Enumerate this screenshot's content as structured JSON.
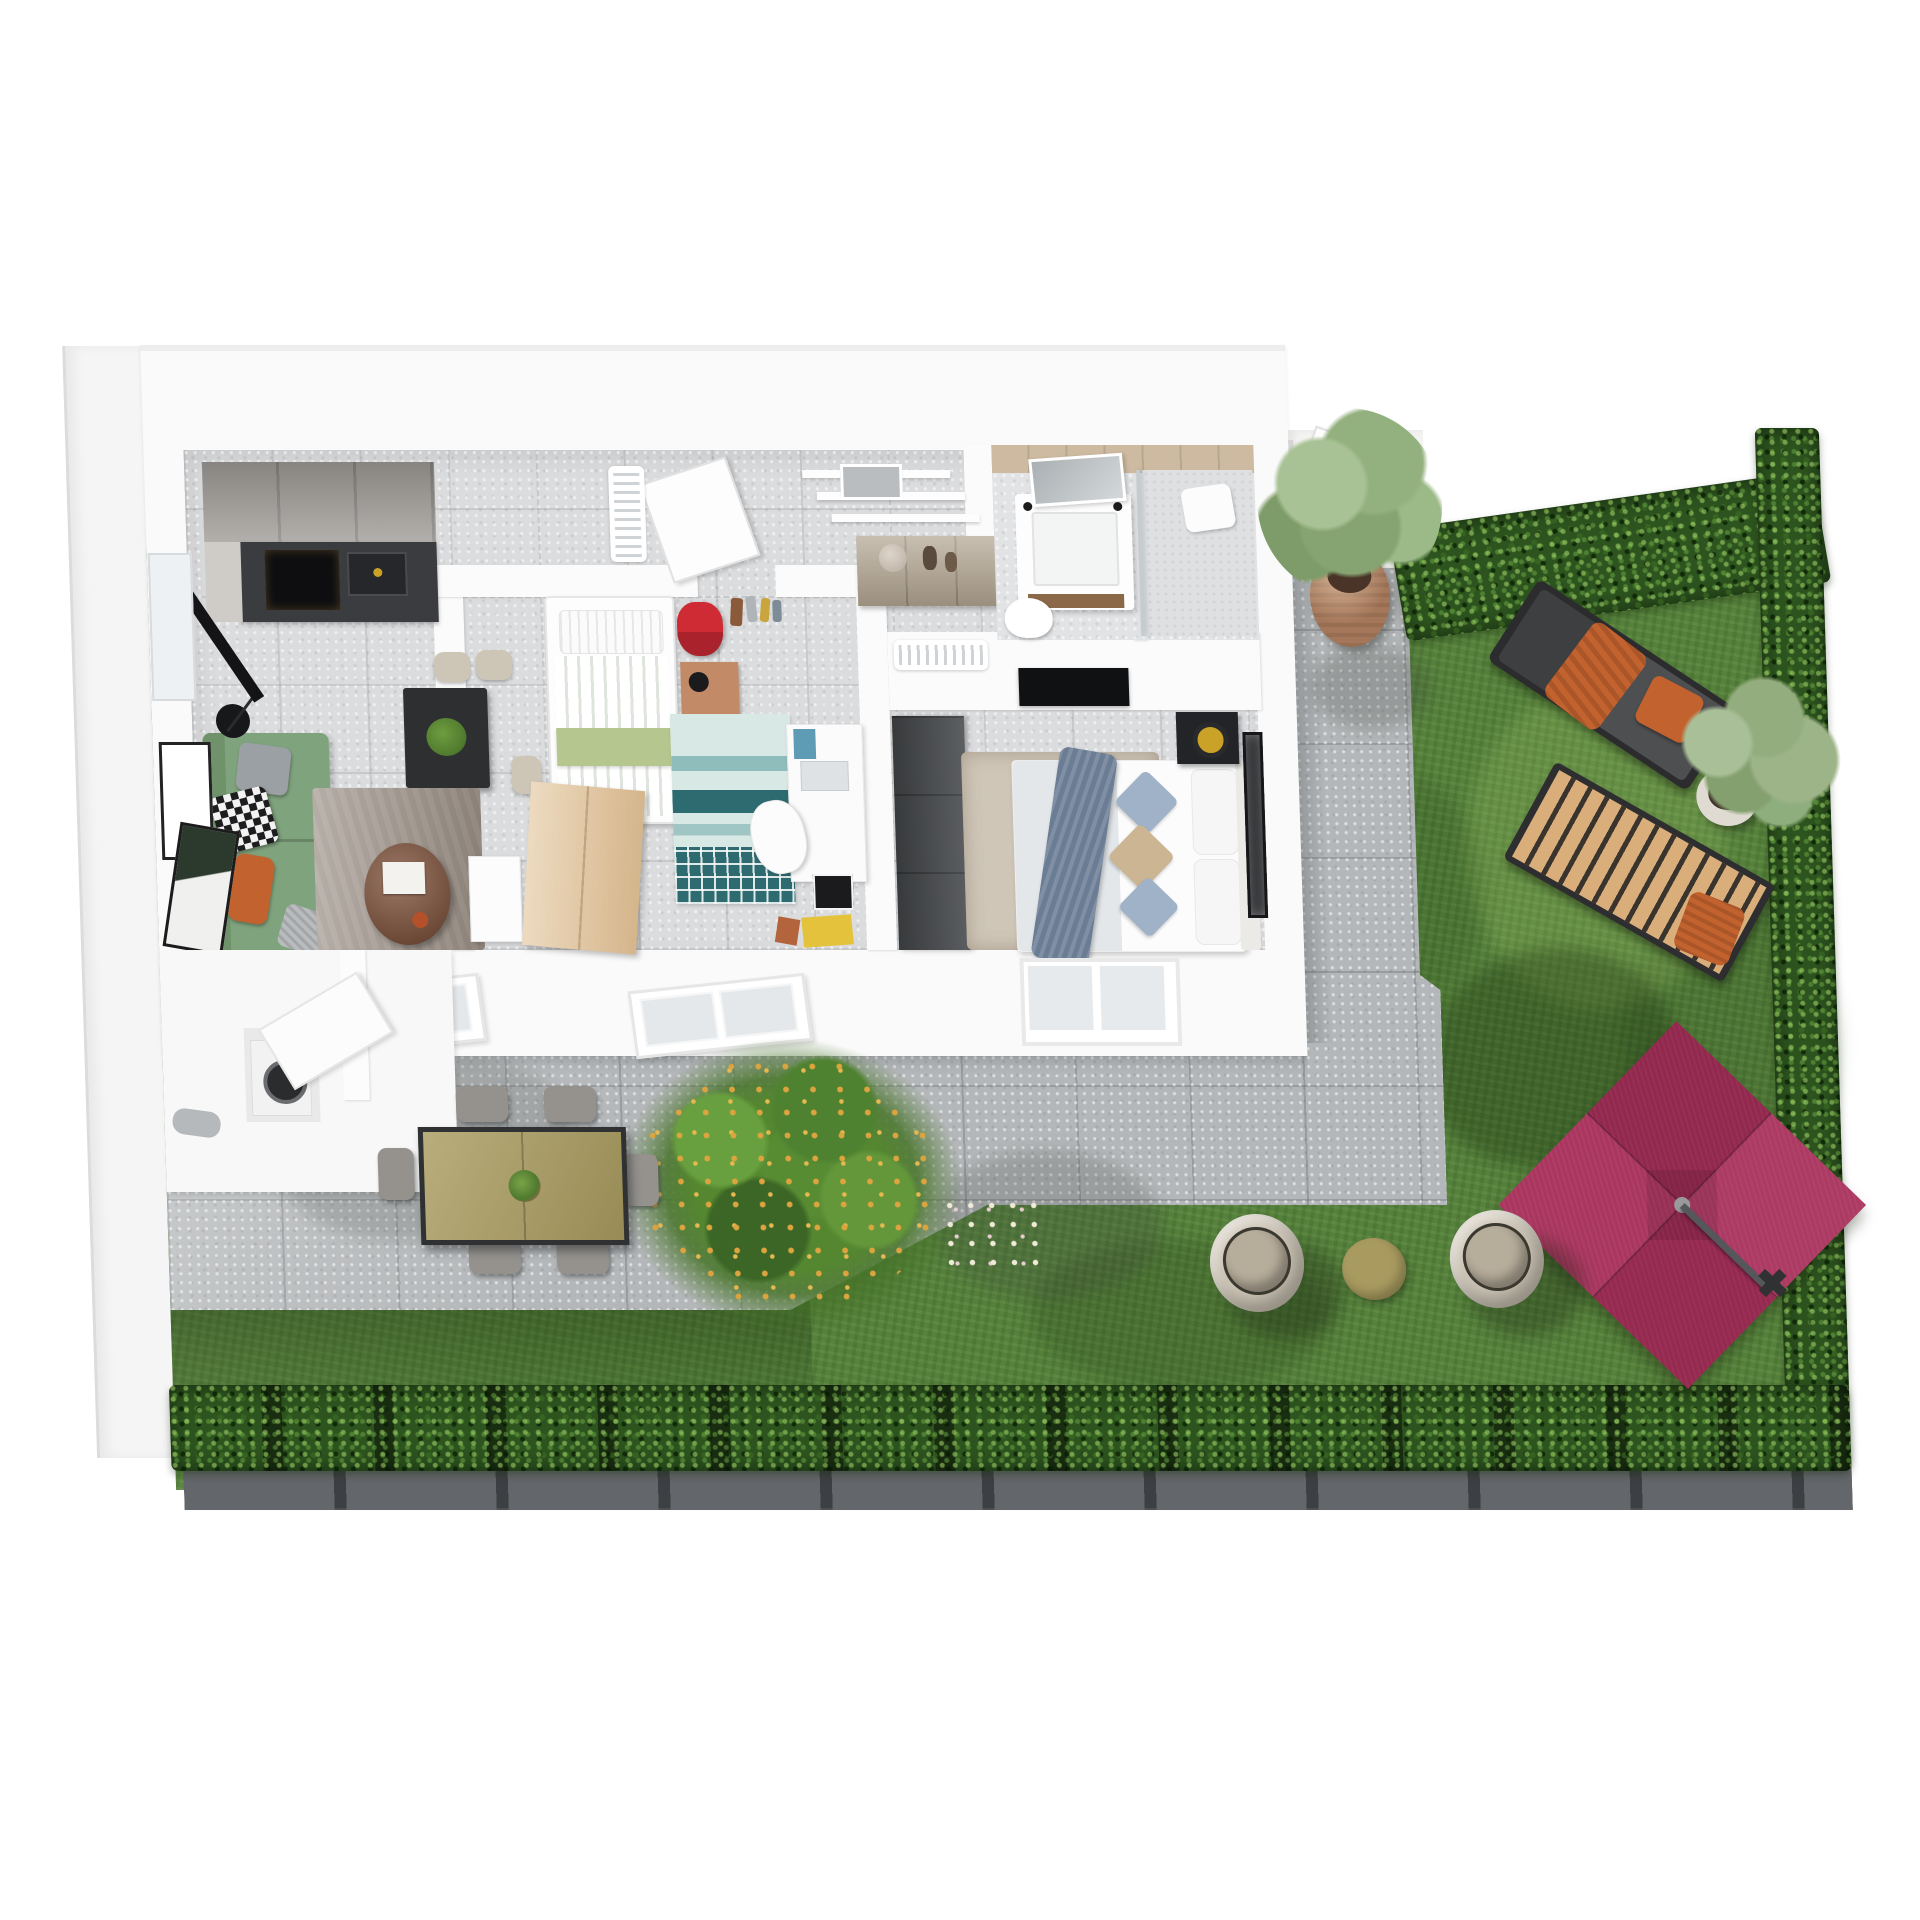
{
  "scene": {
    "type": "3d-floorplan-render",
    "view": "top-down-isometric",
    "subject": "two-bedroom-apartment-with-terrace-and-garden"
  },
  "colors": {
    "background": "#ffffff",
    "slab": "#f5f5f5",
    "wall": "#fafafa",
    "floor_tile": "#dbdcde",
    "terrace_tile": "#b4b7b9",
    "grass": "#55813c",
    "hedge": "#2d541f",
    "gravel": "#3d4043",
    "umbrella": "#a72e59",
    "umbrella_pole": "#55575a",
    "sofa": "#7fa37d",
    "accent_orange": "#c2622e",
    "rug_living": "#a69c93",
    "coffee_table": "#7b4b33",
    "dining_table": "#2e2f31",
    "chair_beige": "#cdc5b6",
    "kitchen_counter": "#3b3c40",
    "kitchen_cabinet": "#a5a19d",
    "bed_green_band": "#b5c78f",
    "teal_rug": "#2e6b70",
    "wood_light": "#e3c79e",
    "wardrobe_dark": "#4a4d50",
    "backpack_red": "#cf2b35",
    "nightstand_wood": "#c28a66",
    "master_throw": "#6b7d94",
    "pillow_blue": "#9fb2c8",
    "pillow_beige": "#cbb592",
    "rug_master": "#cfc6b8",
    "bath_tile": "#cdbaa0",
    "terracotta": "#a5775a",
    "pot_white": "#dfdbd2",
    "foliage_sage": "#93b17e",
    "foliage_dark": "#4f8230",
    "lounger_pad": "#4e4f51",
    "wood_slats": "#d9ae7a",
    "table_olive": "#a99b5f",
    "flower_yellow": "#dca43e"
  },
  "apartment": {
    "rooms": [
      {
        "id": "living-kitchen",
        "furniture": [
          "kitchen-cabinets",
          "induction-hob",
          "kitchen-sink",
          "dining-table",
          "dining-chairs-3",
          "potted-plant",
          "green-sofa",
          "gray-pillow",
          "checkered-pillow",
          "orange-pillow",
          "gray-throw",
          "coffee-table",
          "area-rug",
          "floor-lamp",
          "tv",
          "side-shelf",
          "wall-art-2",
          "window"
        ]
      },
      {
        "id": "kids-bedroom",
        "furniture": [
          "single-bed",
          "striped-duvet",
          "green-blanket-band",
          "wood-wardrobe",
          "nightstand",
          "black-lamp",
          "red-backpack",
          "wall-hooks",
          "teal-pattern-rug",
          "desk",
          "desk-chair",
          "poster",
          "yellow-box"
        ]
      },
      {
        "id": "hallway",
        "furniture": [
          "wall-shelves",
          "sideboard",
          "vase",
          "bottles",
          "leaning-door",
          "ac-vent"
        ]
      },
      {
        "id": "bathroom",
        "furniture": [
          "vanity-sink",
          "tilted-mirror",
          "walk-in-shower",
          "glass-partition",
          "towel",
          "toilet",
          "beige-tile-band"
        ]
      },
      {
        "id": "master-bedroom",
        "furniture": [
          "double-bed",
          "blue-throw",
          "pillow-blue-2",
          "pillow-beige",
          "white-pillows-2",
          "black-nightstand",
          "brass-lamp",
          "dark-wardrobe",
          "tv-panel",
          "ac-vent",
          "area-rug",
          "wall-art",
          "window"
        ]
      },
      {
        "id": "utility-entry",
        "furniture": [
          "washing-machine",
          "open-door",
          "door-handle"
        ]
      }
    ]
  },
  "terrace": {
    "elements": [
      "large-tile-paving",
      "outdoor-dining-table",
      "outdoor-chairs-6",
      "centerpiece-plant",
      "roof-window-pair-left",
      "roof-window-pair-right",
      "tree-shadows"
    ]
  },
  "garden": {
    "elements": [
      "lawn",
      "hedge-top",
      "hedge-right",
      "hedge-bottom",
      "gravel-border",
      "terracotta-planter-tree",
      "white-planter-shrub",
      "sun-lounger-with-orange-cushions",
      "wooden-slat-lounger",
      "orange-towel",
      "crimson-cantilever-umbrella",
      "umbrella-pole",
      "lounge-pod-chair-left",
      "lounge-pod-chair-right",
      "khaki-side-table",
      "flowering-bush-yellow",
      "white-flowers",
      "entry-walkway",
      "entry-door"
    ]
  }
}
